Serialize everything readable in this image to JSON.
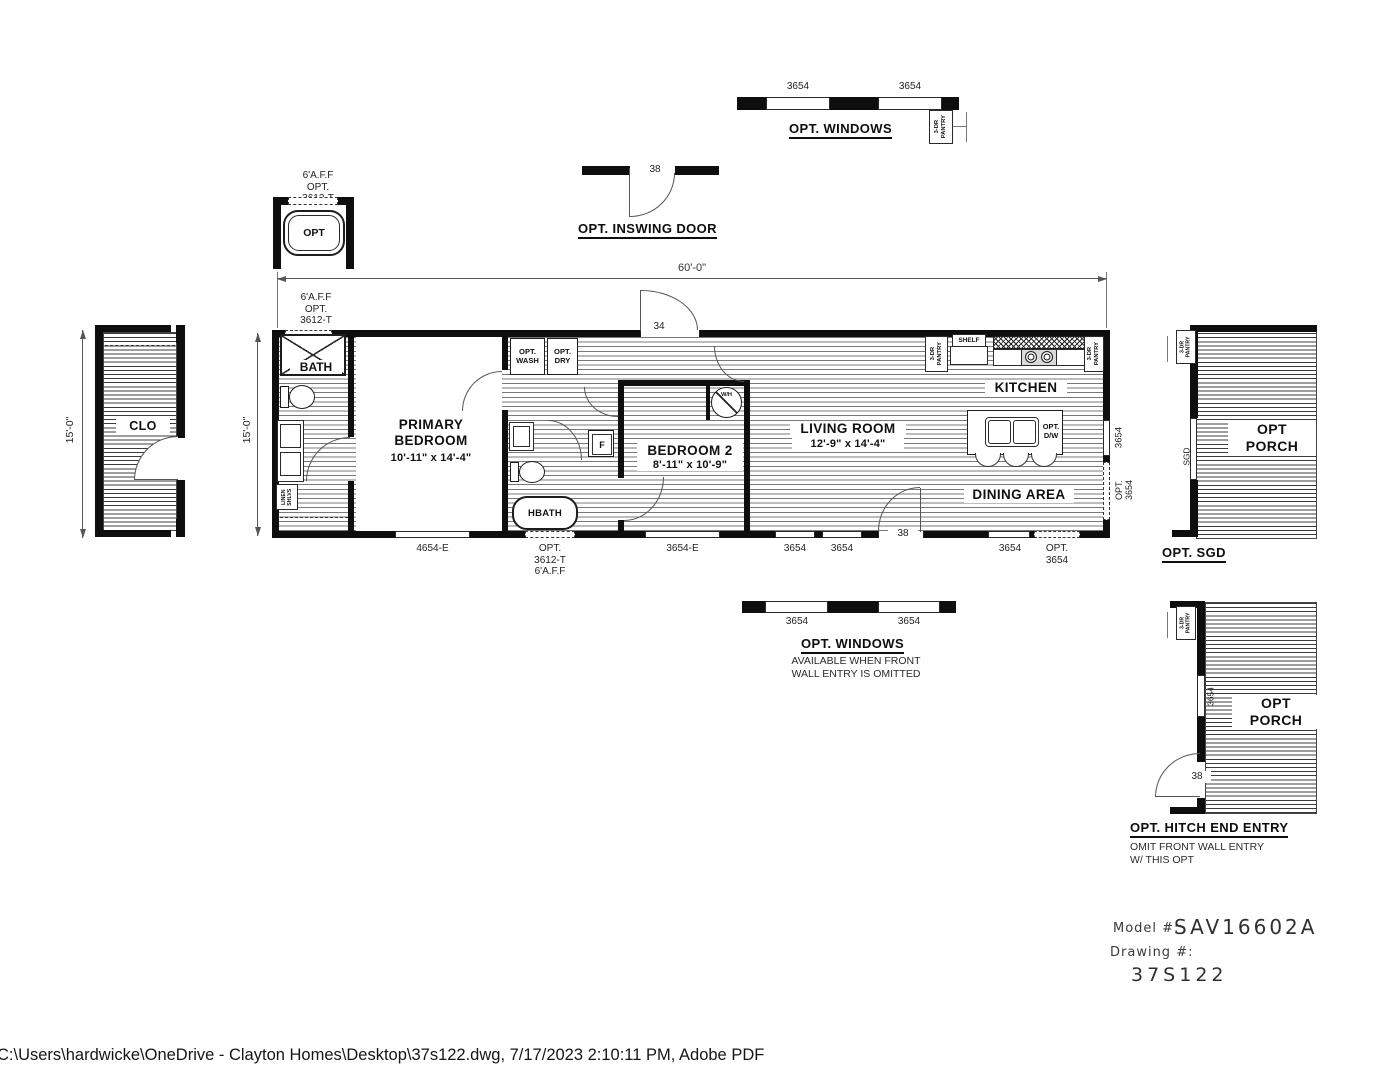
{
  "footer": {
    "path": "C:\\Users\\hardwicke\\OneDrive - Clayton Homes\\Desktop\\37s122.dwg, 7/17/2023 2:10:11 PM, Adobe PDF"
  },
  "title_block": {
    "model_label": "Model #:",
    "model_value": "SAV16602A",
    "drawing_label": "Drawing #:",
    "drawing_value": "37S122"
  },
  "dimensions": {
    "overall_width": "60'-0\"",
    "main_height": "15'-0\"",
    "clo_height": "15'-0\""
  },
  "details": {
    "opt_windows_top": {
      "caption": "OPT. WINDOWS",
      "win1": "3654",
      "win2": "3654"
    },
    "opt_inswing_door": {
      "caption": "OPT. INSWING DOOR",
      "door": "38"
    },
    "opt_tub": {
      "tub": "OPT",
      "window": "6'A.F.F\nOPT.\n3612-T"
    },
    "opt_sgd_porch": {
      "caption": "OPT. SGD",
      "label": "OPT\nPORCH",
      "sgd": "SGD"
    },
    "opt_windows_bottom": {
      "caption": "OPT. WINDOWS",
      "note": "AVAILABLE WHEN FRONT\nWALL ENTRY IS OMITTED",
      "win1": "3654",
      "win2": "3654"
    },
    "hitch_entry": {
      "caption": "OPT. HITCH END ENTRY",
      "note": "OMIT FRONT WALL ENTRY\nW/ THIS OPT",
      "label": "OPT\nPORCH",
      "window": "3654",
      "door": "38"
    }
  },
  "plan": {
    "clo": "CLO",
    "bath": "BATH",
    "linen": "LINEN\nSHLVS",
    "primary_bedroom": {
      "name": "PRIMARY\nBEDROOM",
      "size": "10'-11\" x  14'-4\""
    },
    "bedroom2": {
      "name": "BEDROOM 2",
      "size": "8'-11\" x  10'-9\""
    },
    "living": {
      "name": "LIVING ROOM",
      "size": "12'-9\" x  14'-4\""
    },
    "kitchen": "KITCHEN",
    "dining": "DINING AREA",
    "hbath": "HBATH",
    "opt_wash": "OPT.\nWASH",
    "opt_dry": "OPT.\nDRY",
    "shelf": "SHELF",
    "pantry": "3-DR\nPANTRY",
    "furnace": "F",
    "water_heater": "W/H",
    "opt_dw": "OPT.\nD/W",
    "top_window_label": "6'A.F.F\nOPT.\n3612-T",
    "door_top": "34",
    "door_front": "38",
    "windows_bottom": [
      "4654-E",
      "OPT.\n3612-T\n6'A.F.F",
      "3654-E",
      "3654",
      "3654",
      "3654",
      "OPT.\n3654"
    ],
    "windows_right": [
      "3654",
      "OPT.\n3654"
    ]
  }
}
